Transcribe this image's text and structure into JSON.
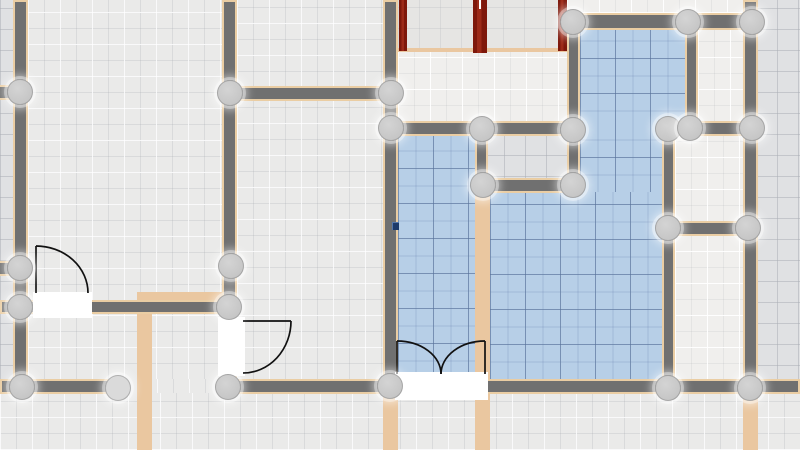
{
  "app": {
    "name": "floor-plan-editor",
    "view": "2d-plan-canvas"
  },
  "canvas": {
    "width": 800,
    "height": 450
  },
  "colors": {
    "background": "#e0e1e3",
    "wall": "#707070",
    "wall_outline": "#eacda3",
    "partition": "#eac7a0",
    "brick": "#9c2a18",
    "brick_dark": "#7e180b",
    "brick_window_tick": "#ffffff",
    "door": "#ffffff",
    "swing_arc": "#111111",
    "handle": "#c6c6c6",
    "handle_light": "#dadada",
    "floor_blue": "#b7cfe7",
    "floor_light": "#eaeae9",
    "floor_white": "#f0efed",
    "marker": "#1d3a6a"
  },
  "plan": {
    "floors": [
      {
        "kind": "light",
        "x": 28,
        "y": 0,
        "w": 194,
        "h": 301
      },
      {
        "kind": "light",
        "x": 237,
        "y": 0,
        "w": 146,
        "h": 88
      },
      {
        "kind": "light",
        "x": 237,
        "y": 100,
        "w": 146,
        "h": 280
      },
      {
        "kind": "light",
        "x": 28,
        "y": 313,
        "w": 194,
        "h": 67
      },
      {
        "kind": "light",
        "x": 125,
        "y": 379,
        "w": 112,
        "h": 15
      },
      {
        "kind": "light",
        "x": 0,
        "y": 393,
        "w": 800,
        "h": 57
      },
      {
        "kind": "plain",
        "x": 398,
        "y": 0,
        "w": 169,
        "h": 50
      },
      {
        "kind": "white",
        "x": 398,
        "y": 50,
        "w": 169,
        "h": 72
      },
      {
        "kind": "white",
        "x": 567,
        "y": 0,
        "w": 190,
        "h": 13
      },
      {
        "kind": "white",
        "x": 698,
        "y": 30,
        "w": 45,
        "h": 92
      },
      {
        "kind": "white",
        "x": 675,
        "y": 136,
        "w": 68,
        "h": 86
      },
      {
        "kind": "white",
        "x": 675,
        "y": 235,
        "w": 68,
        "h": 145
      },
      {
        "kind": "blue",
        "x": 398,
        "y": 136,
        "w": 77,
        "h": 243
      },
      {
        "kind": "blue",
        "x": 580,
        "y": 30,
        "w": 105,
        "h": 99
      },
      {
        "kind": "blue",
        "x": 580,
        "y": 128,
        "w": 82,
        "h": 65
      },
      {
        "kind": "blue",
        "x": 490,
        "y": 192,
        "w": 172,
        "h": 188
      }
    ],
    "strips": [
      {
        "x": 137,
        "y": 292,
        "w": 15,
        "h": 158
      },
      {
        "x": 140,
        "y": 292,
        "w": 84,
        "h": 9
      },
      {
        "x": 475,
        "y": 192,
        "w": 15,
        "h": 258
      },
      {
        "x": 383,
        "y": 396,
        "w": 15,
        "h": 54
      },
      {
        "x": 743,
        "y": 396,
        "w": 15,
        "h": 54
      },
      {
        "x": 398,
        "y": 48,
        "w": 169,
        "h": 4
      }
    ],
    "walls": [
      {
        "x": 13,
        "y": 0,
        "w": 15,
        "h": 393
      },
      {
        "x": -4,
        "y": 85,
        "w": 18,
        "h": 15
      },
      {
        "x": -4,
        "y": 261,
        "w": 18,
        "h": 15
      },
      {
        "x": 222,
        "y": 0,
        "w": 15,
        "h": 378
      },
      {
        "x": 224,
        "y": 86,
        "w": 174,
        "h": 15
      },
      {
        "x": 383,
        "y": 0,
        "w": 15,
        "h": 394
      },
      {
        "x": 567,
        "y": 13,
        "w": 190,
        "h": 17
      },
      {
        "x": 567,
        "y": 25,
        "w": 13,
        "h": 168
      },
      {
        "x": 383,
        "y": 121,
        "w": 200,
        "h": 15
      },
      {
        "x": 660,
        "y": 121,
        "w": 98,
        "h": 15
      },
      {
        "x": 475,
        "y": 121,
        "w": 13,
        "h": 72
      },
      {
        "x": 475,
        "y": 178,
        "w": 106,
        "h": 15
      },
      {
        "x": 685,
        "y": 25,
        "w": 13,
        "h": 105
      },
      {
        "x": 662,
        "y": 121,
        "w": 13,
        "h": 275
      },
      {
        "x": 743,
        "y": 0,
        "w": 15,
        "h": 396
      },
      {
        "x": 662,
        "y": 221,
        "w": 96,
        "h": 15
      },
      {
        "x": 0,
        "y": 300,
        "w": 231,
        "h": 14
      },
      {
        "x": 0,
        "y": 379,
        "w": 125,
        "h": 15
      },
      {
        "x": 237,
        "y": 379,
        "w": 563,
        "h": 15
      }
    ],
    "red_walls": [
      {
        "x": 399,
        "y": 0,
        "w": 8,
        "h": 51,
        "tick": false
      },
      {
        "x": 473,
        "y": 0,
        "w": 14,
        "h": 53,
        "tick": true
      },
      {
        "x": 558,
        "y": 0,
        "w": 9,
        "h": 51,
        "tick": false
      }
    ],
    "doors": [
      {
        "x": 33,
        "y": 292,
        "w": 59,
        "h": 26
      },
      {
        "x": 218,
        "y": 317,
        "w": 27,
        "h": 59
      },
      {
        "x": 395,
        "y": 372,
        "w": 93,
        "h": 28
      }
    ],
    "door_swings": [
      {
        "leaf": "M 36 293 L 36 246",
        "arc": "M 36 246 A 52 47 0 0 1 88 293"
      },
      {
        "leaf": "M 243 321 L 291 321",
        "arc": "M 291 321 A 48 52 0 0 1 243 373"
      },
      {
        "leaf": "M 397 374 L 397 341",
        "arc": "M 397 341 A 44 33 0 0 1 441 374"
      },
      {
        "leaf": "M 485 374 L 485 341",
        "arc": "M 485 341 A 44 33 0 0 0 441 374"
      }
    ],
    "handles": [
      {
        "x": 573,
        "y": 22
      },
      {
        "x": 688,
        "y": 22
      },
      {
        "x": 752,
        "y": 22
      },
      {
        "x": 20,
        "y": 92
      },
      {
        "x": 230,
        "y": 93
      },
      {
        "x": 391,
        "y": 93
      },
      {
        "x": 391,
        "y": 128
      },
      {
        "x": 482,
        "y": 129
      },
      {
        "x": 573,
        "y": 130
      },
      {
        "x": 668,
        "y": 129
      },
      {
        "x": 690,
        "y": 128
      },
      {
        "x": 752,
        "y": 128
      },
      {
        "x": 483,
        "y": 185
      },
      {
        "x": 573,
        "y": 185
      },
      {
        "x": 668,
        "y": 228
      },
      {
        "x": 748,
        "y": 228
      },
      {
        "x": 20,
        "y": 268
      },
      {
        "x": 231,
        "y": 266
      },
      {
        "x": 20,
        "y": 307
      },
      {
        "x": 229,
        "y": 307
      },
      {
        "x": 22,
        "y": 387
      },
      {
        "x": 118,
        "y": 388,
        "light": true
      },
      {
        "x": 228,
        "y": 387
      },
      {
        "x": 390,
        "y": 386
      },
      {
        "x": 668,
        "y": 388
      },
      {
        "x": 750,
        "y": 388
      }
    ],
    "marker": {
      "x": 392,
      "y": 222,
      "w": 7,
      "h": 8
    }
  }
}
